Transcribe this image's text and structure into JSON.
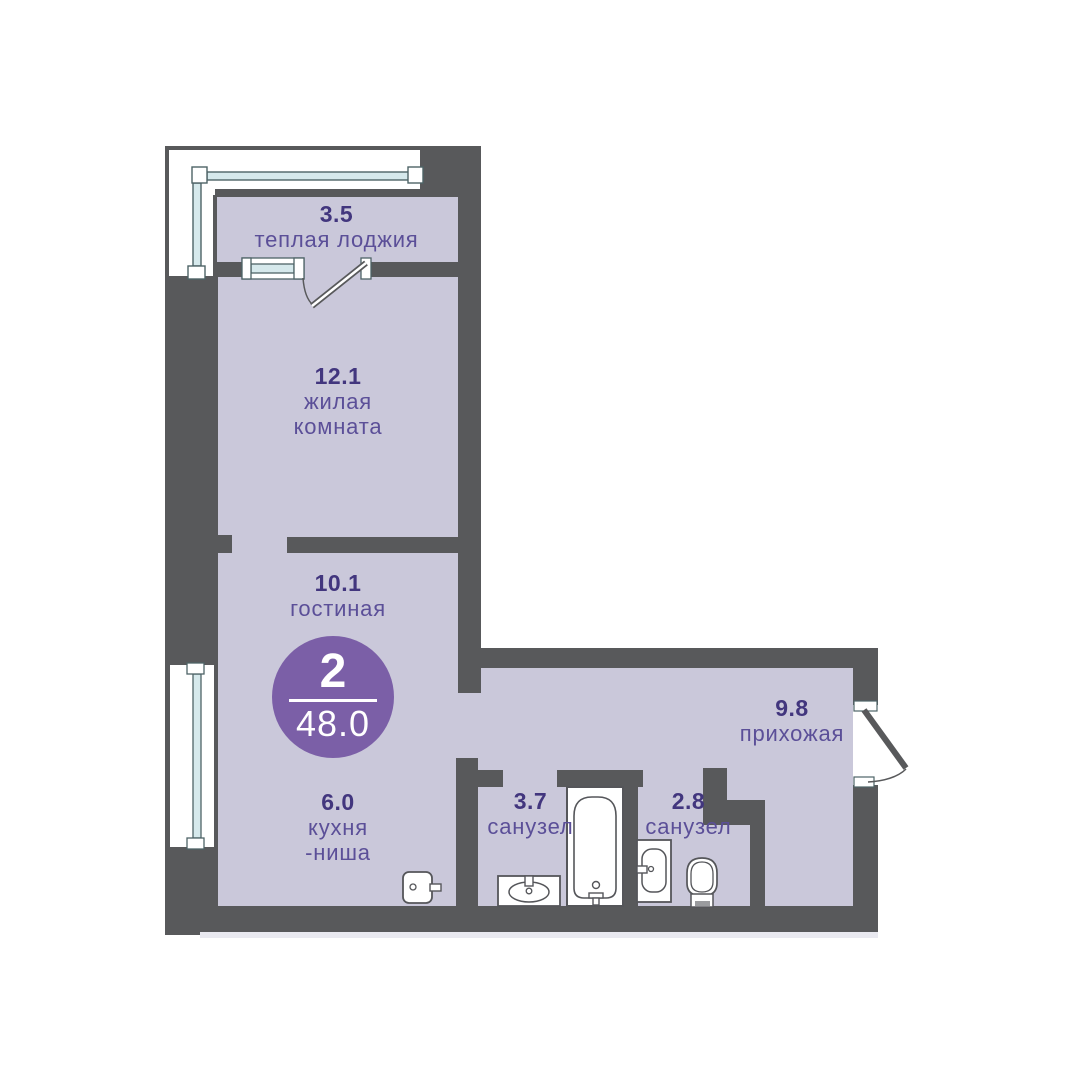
{
  "badge": {
    "rooms_count": "2",
    "total_area": "48.0"
  },
  "rooms": {
    "loggia": {
      "area": "3.5",
      "name_line1": "теплая лоджия"
    },
    "living": {
      "area": "12.1",
      "name_line1": "жилая",
      "name_line2": "комната"
    },
    "lounge": {
      "area": "10.1",
      "name_line1": "гостиная"
    },
    "kitchen": {
      "area": "6.0",
      "name_line1": "кухня",
      "name_line2": "-ниша"
    },
    "hallway": {
      "area": "9.8",
      "name_line1": "прихожая"
    },
    "bath1": {
      "area": "3.7",
      "name_line1": "санузел"
    },
    "bath2": {
      "area": "2.8",
      "name_line1": "санузел"
    }
  },
  "colors": {
    "wall": "#58595b",
    "floor": "#cac8da",
    "area-num": "#42367e",
    "room-name": "#5b4f98",
    "badge": "#7b5fa7",
    "glaze-fill": "#d6e9ec",
    "glaze-stroke": "#4e6367",
    "fixture-stroke": "#55565a"
  }
}
